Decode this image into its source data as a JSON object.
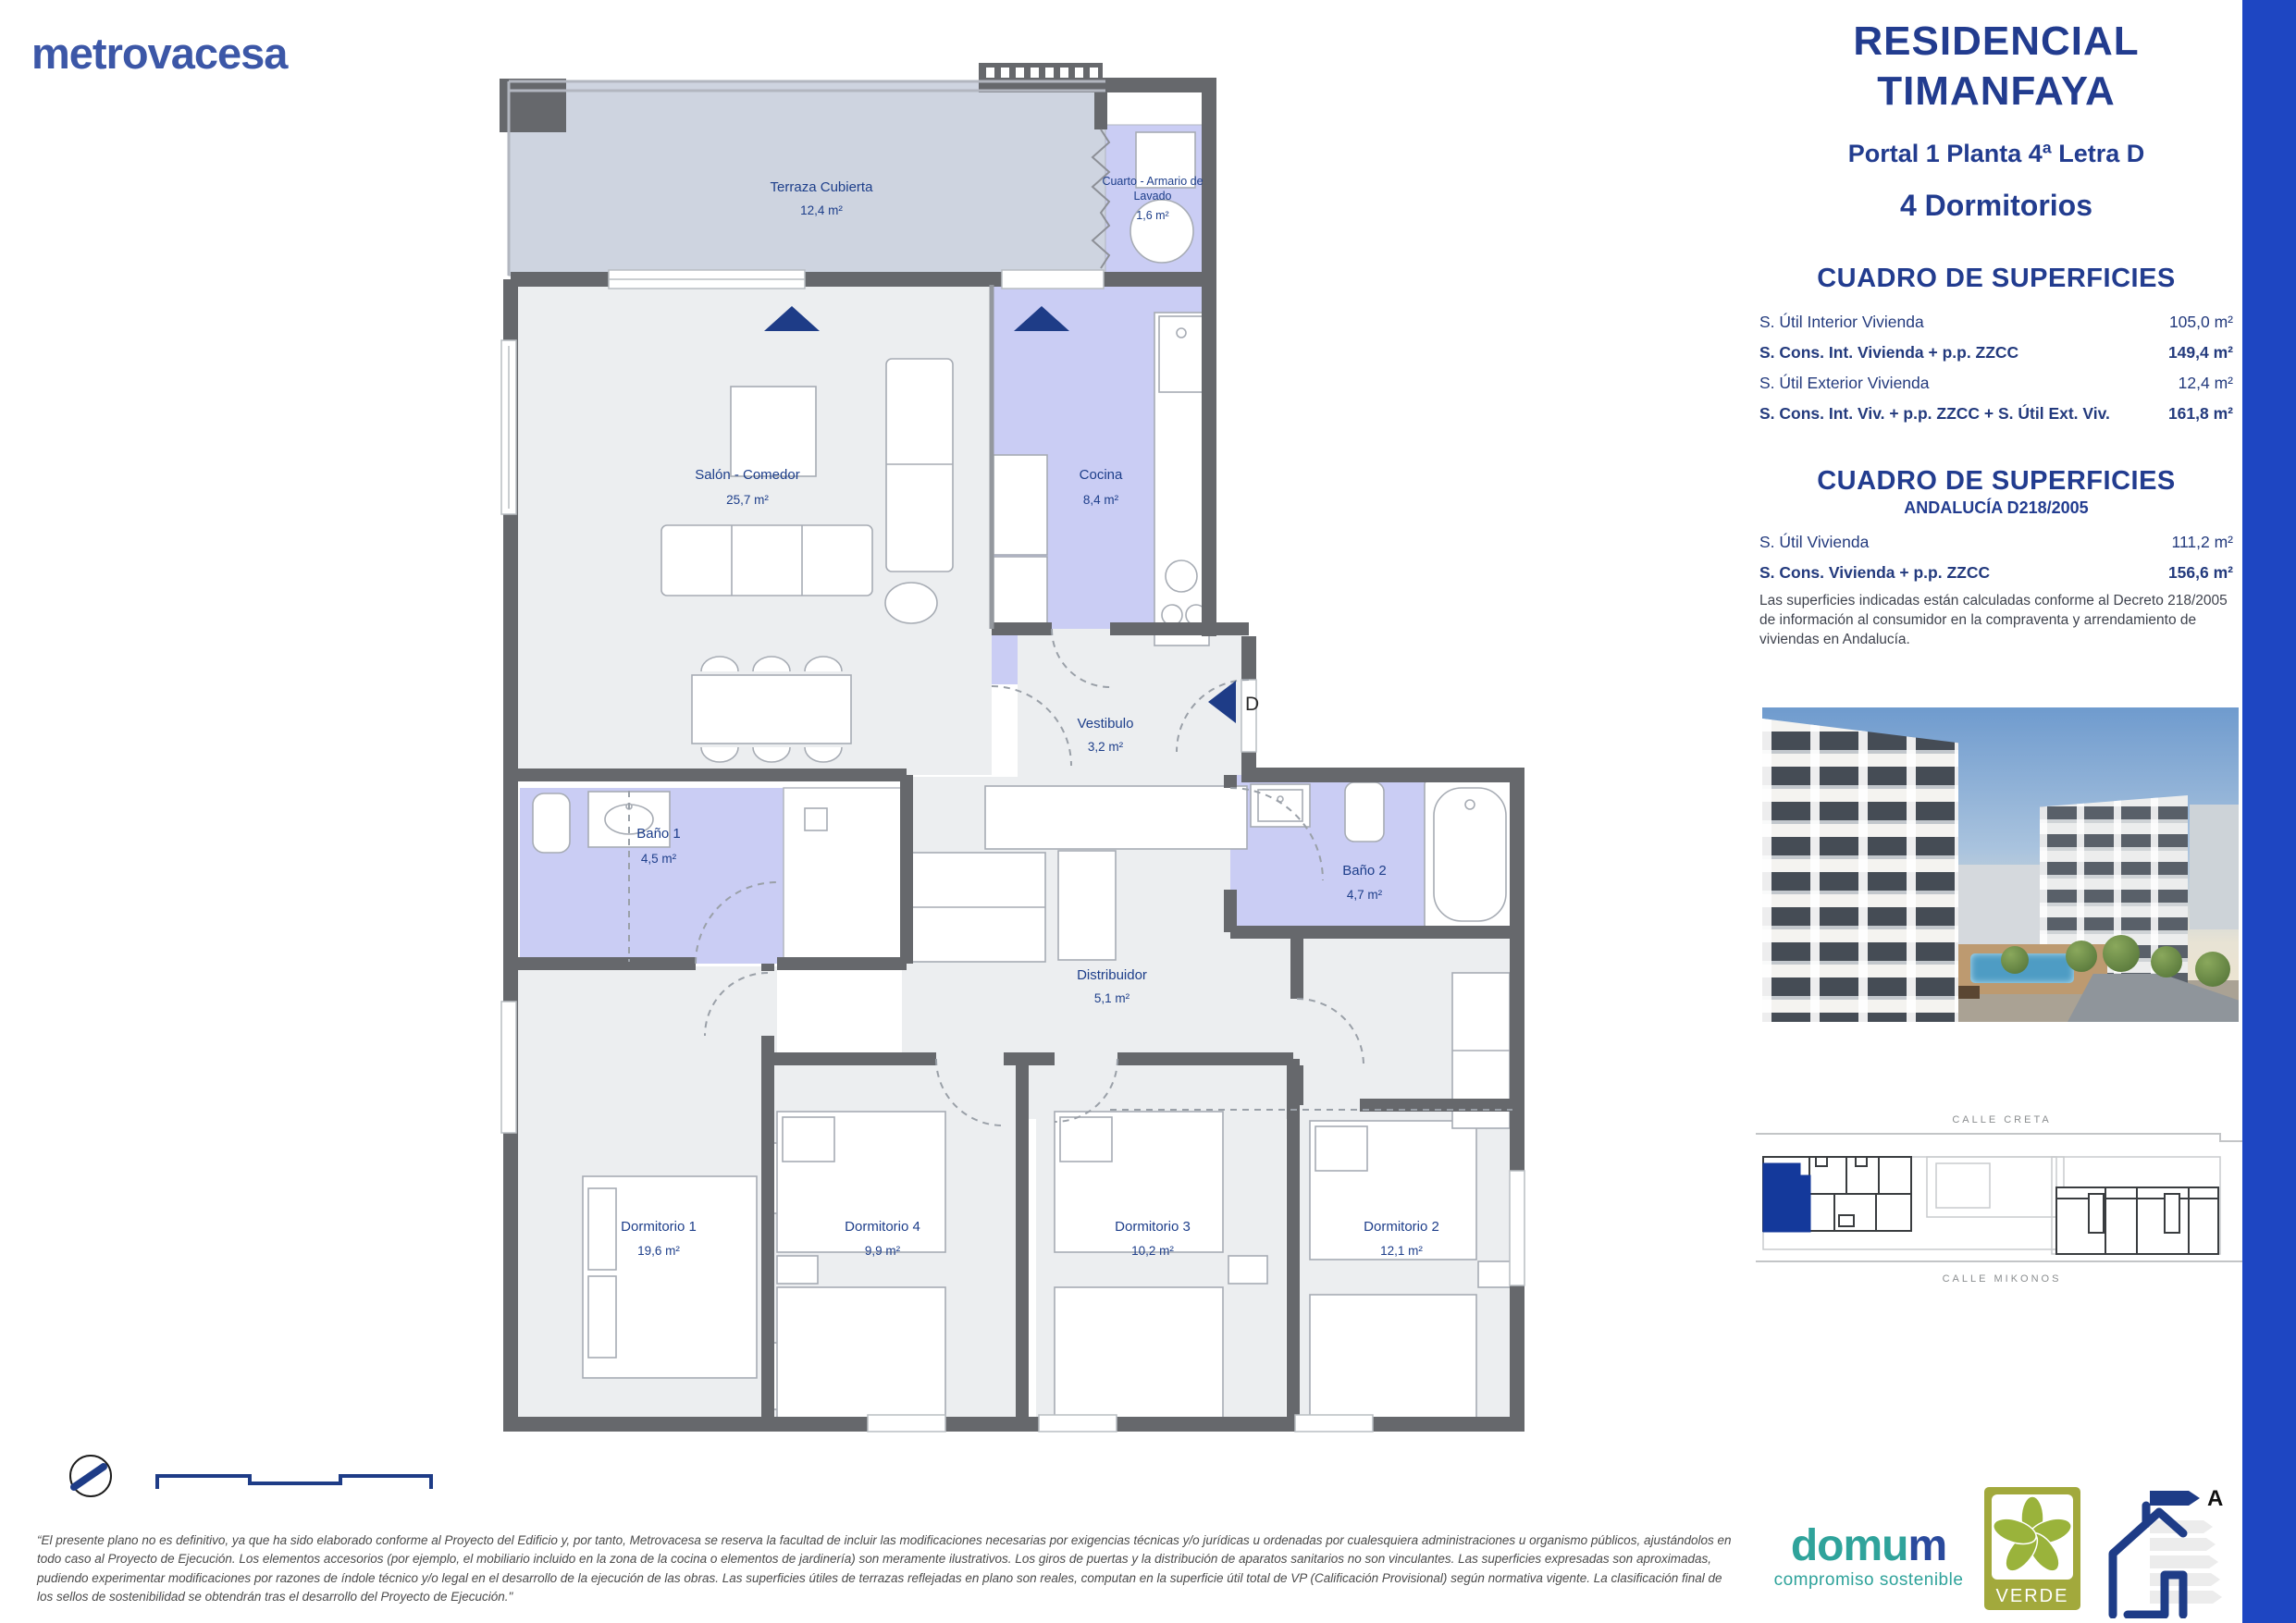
{
  "brand": {
    "logo": "metrovacesa"
  },
  "header": {
    "title_line1": "RESIDENCIAL",
    "title_line2": "TIMANFAYA",
    "location": "Portal 1 Planta 4ª Letra D",
    "dwelling_type": "4 Dormitorios"
  },
  "surfaces": {
    "title": "CUADRO DE SUPERFICIES",
    "rows": [
      {
        "label": "S. Útil Interior Vivienda",
        "value": "105,0 m²"
      },
      {
        "label": "S. Cons. Int. Vivienda + p.p. ZZCC",
        "value": "149,4 m²"
      },
      {
        "label": "S. Útil Exterior Vivienda",
        "value": "12,4 m²"
      },
      {
        "label": "S. Cons. Int. Viv. + p.p. ZZCC + S. Útil Ext. Viv.",
        "value": "161,8 m²"
      }
    ]
  },
  "surfaces_andalucia": {
    "title": "CUADRO DE SUPERFICIES",
    "subtitle": "ANDALUCÍA D218/2005",
    "rows": [
      {
        "label": "S. Útil Vivienda",
        "value": "111,2 m²"
      },
      {
        "label": "S. Cons. Vivienda + p.p. ZZCC",
        "value": "156,6 m²"
      }
    ],
    "note": "Las superficies indicadas están calculadas conforme al Decreto 218/2005 de información al consumidor en la compraventa y arrendamiento de viviendas en Andalucía."
  },
  "plan": {
    "entrance_label": "D",
    "rooms": {
      "terraza": {
        "name": "Terraza Cubierta",
        "area": "12,4 m²"
      },
      "lavado": {
        "name_line1": "Cuarto - Armario de",
        "name_line2": "Lavado",
        "area": "1,6 m²"
      },
      "salon": {
        "name": "Salón - Comedor",
        "area": "25,7 m²"
      },
      "cocina": {
        "name": "Cocina",
        "area": "8,4 m²"
      },
      "vestibulo": {
        "name": "Vestibulo",
        "area": "3,2 m²"
      },
      "bano1": {
        "name": "Baño 1",
        "area": "4,5 m²"
      },
      "bano2": {
        "name": "Baño 2",
        "area": "4,7 m²"
      },
      "distribuidor": {
        "name": "Distribuidor",
        "area": "5,1 m²"
      },
      "dormitorio1": {
        "name": "Dormitorio 1",
        "area": "19,6 m²"
      },
      "dormitorio4": {
        "name": "Dormitorio 4",
        "area": "9,9 m²"
      },
      "dormitorio3": {
        "name": "Dormitorio 3",
        "area": "10,2 m²"
      },
      "dormitorio2": {
        "name": "Dormitorio 2",
        "area": "12,1 m²"
      }
    }
  },
  "site_plan": {
    "street_top": "CALLE CRETA",
    "street_bottom": "CALLE MIKONOS"
  },
  "footer": {
    "disclaimer": "“El presente plano no es definitivo, ya que ha sido elaborado conforme al Proyecto del Edificio y, por tanto, Metrovacesa se reserva la facultad de incluir las modificaciones necesarias por exigencias técnicas y/o jurídicas u ordenadas por cualesquiera administraciones u organismo públicos, ajustándolos en todo caso al Proyecto de Ejecución. Los elementos accesorios (por ejemplo, el mobiliario incluido en la zona de la cocina o elementos de jardinería) son meramente ilustrativos. Los giros de puertas y la distribución de aparatos sanitarios no son vinculantes. Las superficies expresadas son aproximadas, pudiendo experimentar modificaciones por razones de índole técnico y/o legal en el desarrollo de la ejecución de las obras. Las superficies útiles de terrazas reflejadas en plano son reales, computan en la superficie útil total de VP (Calificación Provisional) según normativa vigente. La clasificación final de los sellos de sostenibilidad se obtendrán tras el desarrollo del Proyecto de Ejecución.\""
  },
  "logos": {
    "domum": {
      "part1": "domu",
      "part2": "m",
      "tagline": "compromiso sostenible"
    },
    "verde": {
      "label": "VERDE"
    },
    "energy": {
      "rating": "A"
    }
  },
  "colors": {
    "navy": "#223c8f",
    "accent_bar": "#1e46c2",
    "logo_blue": "#3c57a7",
    "wall": "#66686c",
    "terrace_fill": "#ced4e0",
    "wet_room_fill": "#cacdf4",
    "room_fill": "#eceef0",
    "site_highlight": "#14399b"
  }
}
